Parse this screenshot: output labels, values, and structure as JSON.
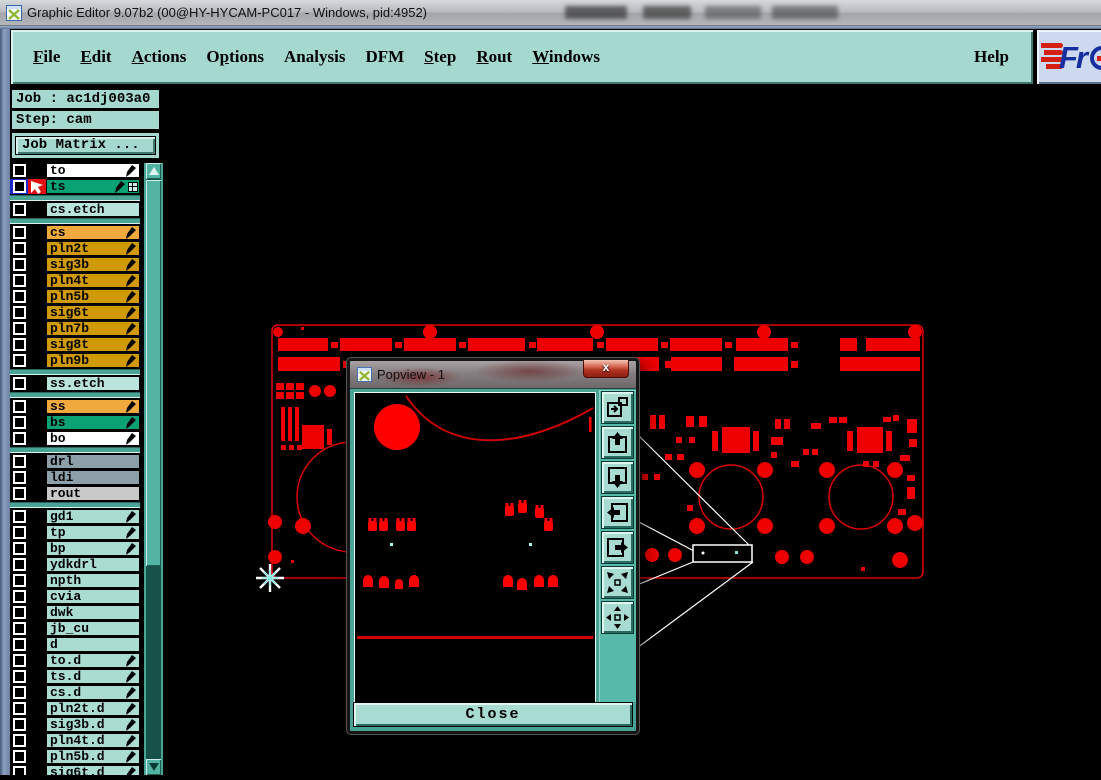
{
  "titlebar": {
    "title": "Graphic Editor 9.07b2 (00@HY-HYCAM-PC017 - Windows, pid:4952)"
  },
  "menubar": {
    "items": [
      {
        "label": "File",
        "u": 0
      },
      {
        "label": "Edit",
        "u": 0
      },
      {
        "label": "Actions",
        "u": 0
      },
      {
        "label": "Options",
        "u": 1
      },
      {
        "label": "Analysis",
        "u": -1
      },
      {
        "label": "DFM",
        "u": -1
      },
      {
        "label": "Step",
        "u": 0
      },
      {
        "label": "Rout",
        "u": 0
      },
      {
        "label": "Windows",
        "u": 0
      }
    ],
    "help": {
      "label": "Help",
      "u": -1
    }
  },
  "logo": {
    "text": "Fr"
  },
  "sidebar": {
    "job_label": "Job : ac1dj003a0",
    "step_label": "Step: cam",
    "job_matrix_label": "Job Matrix ..."
  },
  "layers": {
    "entries": [
      {
        "type": "layer",
        "name": "to",
        "bg": "#ffffff",
        "nib": true,
        "checkbox": "plain"
      },
      {
        "type": "layer",
        "name": "ts",
        "bg": "#0aa173",
        "nib": true,
        "checkbox": "active",
        "marker": true,
        "grid_icon": true
      },
      {
        "type": "sep"
      },
      {
        "type": "layer",
        "name": "cs.etch",
        "bg": "#b9e4dc",
        "nib": false,
        "checkbox": "plain"
      },
      {
        "type": "sep"
      },
      {
        "type": "layer",
        "name": "cs",
        "bg": "#efa93d",
        "nib": true,
        "checkbox": "plain"
      },
      {
        "type": "layer",
        "name": "pln2t",
        "bg": "#cf9a05",
        "nib": true,
        "checkbox": "plain"
      },
      {
        "type": "layer",
        "name": "sig3b",
        "bg": "#cf9a05",
        "nib": true,
        "checkbox": "plain"
      },
      {
        "type": "layer",
        "name": "pln4t",
        "bg": "#cf9a05",
        "nib": true,
        "checkbox": "plain"
      },
      {
        "type": "layer",
        "name": "pln5b",
        "bg": "#cf9a05",
        "nib": true,
        "checkbox": "plain"
      },
      {
        "type": "layer",
        "name": "sig6t",
        "bg": "#cf9a05",
        "nib": true,
        "checkbox": "plain"
      },
      {
        "type": "layer",
        "name": "pln7b",
        "bg": "#cf9a05",
        "nib": true,
        "checkbox": "plain"
      },
      {
        "type": "layer",
        "name": "sig8t",
        "bg": "#cf9a05",
        "nib": true,
        "checkbox": "plain"
      },
      {
        "type": "layer",
        "name": "pln9b",
        "bg": "#cf9a05",
        "nib": true,
        "checkbox": "plain"
      },
      {
        "type": "sep"
      },
      {
        "type": "layer",
        "name": "ss.etch",
        "bg": "#b9e4dc",
        "nib": false,
        "checkbox": "plain"
      },
      {
        "type": "sep"
      },
      {
        "type": "layer",
        "name": "ss",
        "bg": "#efa93d",
        "nib": true,
        "checkbox": "plain"
      },
      {
        "type": "layer",
        "name": "bs",
        "bg": "#0aa173",
        "nib": true,
        "checkbox": "plain"
      },
      {
        "type": "layer",
        "name": "bo",
        "bg": "#ffffff",
        "nib": true,
        "checkbox": "plain"
      },
      {
        "type": "sep"
      },
      {
        "type": "layer",
        "name": "drl",
        "bg": "#8d9fa8",
        "nib": false,
        "checkbox": "plain"
      },
      {
        "type": "layer",
        "name": "ldi",
        "bg": "#8d9fa8",
        "nib": false,
        "checkbox": "plain"
      },
      {
        "type": "layer",
        "name": "rout",
        "bg": "#c9c9c9",
        "nib": false,
        "checkbox": "plain"
      },
      {
        "type": "sep"
      },
      {
        "type": "layer",
        "name": "gd1",
        "bg": "#aadcd2",
        "nib": true,
        "checkbox": "plain"
      },
      {
        "type": "layer",
        "name": "tp",
        "bg": "#aadcd2",
        "nib": true,
        "checkbox": "plain"
      },
      {
        "type": "layer",
        "name": "bp",
        "bg": "#aadcd2",
        "nib": true,
        "checkbox": "plain"
      },
      {
        "type": "layer",
        "name": "ydkdrl",
        "bg": "#aadcd2",
        "nib": false,
        "checkbox": "plain"
      },
      {
        "type": "layer",
        "name": "npth",
        "bg": "#aadcd2",
        "nib": false,
        "checkbox": "plain"
      },
      {
        "type": "layer",
        "name": "cvia",
        "bg": "#aadcd2",
        "nib": false,
        "checkbox": "plain"
      },
      {
        "type": "layer",
        "name": "dwk",
        "bg": "#aadcd2",
        "nib": false,
        "checkbox": "plain"
      },
      {
        "type": "layer",
        "name": "jb_cu",
        "bg": "#aadcd2",
        "nib": false,
        "checkbox": "plain"
      },
      {
        "type": "layer",
        "name": "d",
        "bg": "#aadcd2",
        "nib": false,
        "checkbox": "plain"
      },
      {
        "type": "layer",
        "name": "to.d",
        "bg": "#aadcd2",
        "nib": true,
        "checkbox": "plain"
      },
      {
        "type": "layer",
        "name": "ts.d",
        "bg": "#aadcd2",
        "nib": true,
        "checkbox": "plain"
      },
      {
        "type": "layer",
        "name": "cs.d",
        "bg": "#aadcd2",
        "nib": true,
        "checkbox": "plain"
      },
      {
        "type": "layer",
        "name": "pln2t.d",
        "bg": "#aadcd2",
        "nib": true,
        "checkbox": "plain"
      },
      {
        "type": "layer",
        "name": "sig3b.d",
        "bg": "#aadcd2",
        "nib": true,
        "checkbox": "plain"
      },
      {
        "type": "layer",
        "name": "pln4t.d",
        "bg": "#aadcd2",
        "nib": true,
        "checkbox": "plain"
      },
      {
        "type": "layer",
        "name": "pln5b.d",
        "bg": "#aadcd2",
        "nib": true,
        "checkbox": "plain"
      },
      {
        "type": "layer",
        "name": "sig6t.d",
        "bg": "#aadcd2",
        "nib": true,
        "checkbox": "plain"
      }
    ]
  },
  "popview": {
    "title": "Popview - 1",
    "close_x": "x",
    "close_label": "Close",
    "buttons": [
      {
        "name": "duplicate-view-button",
        "icon": "duplicate-view-icon"
      },
      {
        "name": "pan-up-button",
        "icon": "pan-up-icon"
      },
      {
        "name": "pan-down-button",
        "icon": "pan-down-icon"
      },
      {
        "name": "pan-left-button",
        "icon": "pan-left-icon"
      },
      {
        "name": "pan-right-button",
        "icon": "pan-right-icon"
      },
      {
        "name": "zoom-contract-button",
        "icon": "arrows-inward-icon"
      },
      {
        "name": "zoom-expand-button",
        "icon": "arrows-outward-icon"
      }
    ]
  },
  "colors": {
    "panel_teal": "#a5d8cf",
    "pale_aqua": "#aadcd2",
    "layer_green": "#0aa173",
    "layer_gold": "#cf9a05",
    "layer_orange": "#efa93d",
    "layer_bluegray": "#8d9fa8",
    "pcb_red": "#ee0000",
    "canvas_black": "#000000",
    "callout_white": "#ffffff",
    "marker_cyan": "#7fe8e0",
    "logo_blue": "#162fa0",
    "logo_red": "#d41f12"
  }
}
